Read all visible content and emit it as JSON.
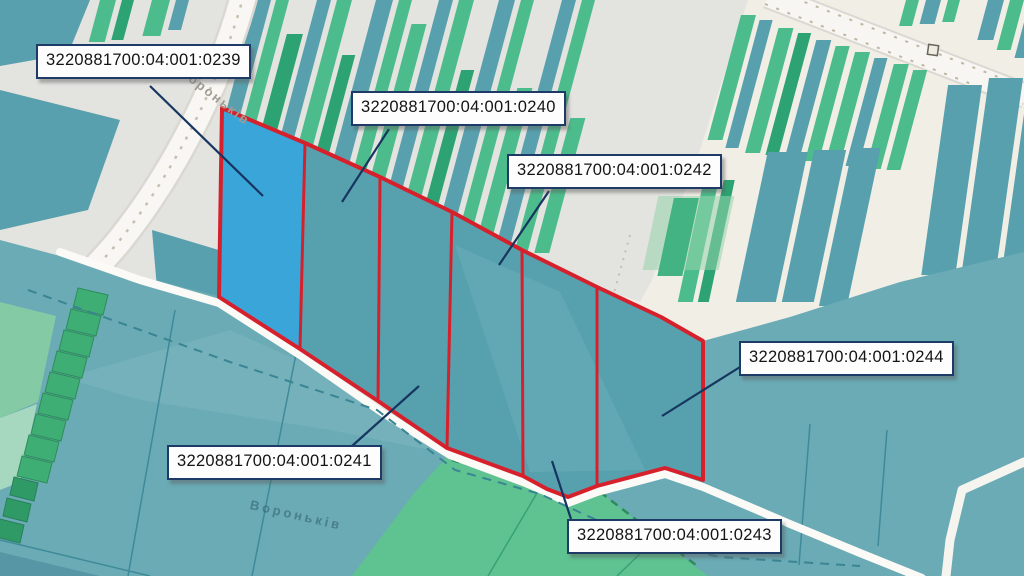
{
  "map": {
    "streets": [
      {
        "name": "Вороньків"
      },
      {
        "name": "Вороньків"
      }
    ],
    "parcels": [
      {
        "cadastral_number": "3220881700:04:001:0239",
        "highlighted": true
      },
      {
        "cadastral_number": "3220881700:04:001:0240",
        "highlighted": false
      },
      {
        "cadastral_number": "3220881700:04:001:0241",
        "highlighted": false
      },
      {
        "cadastral_number": "3220881700:04:001:0242",
        "highlighted": false
      },
      {
        "cadastral_number": "3220881700:04:001:0243",
        "highlighted": false
      },
      {
        "cadastral_number": "3220881700:04:001:0244",
        "highlighted": false
      }
    ]
  },
  "colors": {
    "selection_blue": "#3aa5d9",
    "boundary_red": "#d6212c",
    "leader_navy": "#16355f",
    "label_border_navy": "#1e3a66",
    "field_teal": "#6aabb5",
    "parcel_teal": "#57a1af",
    "strip_green": "#4cbc8c",
    "strip_green_dark": "#2da273",
    "strip_teal": "#58a0ae",
    "bottom_field_green": "#5fc391",
    "background_cream": "#f1eee6",
    "background_gray": "#e3e3df",
    "road_white": "#f8f7f4"
  }
}
